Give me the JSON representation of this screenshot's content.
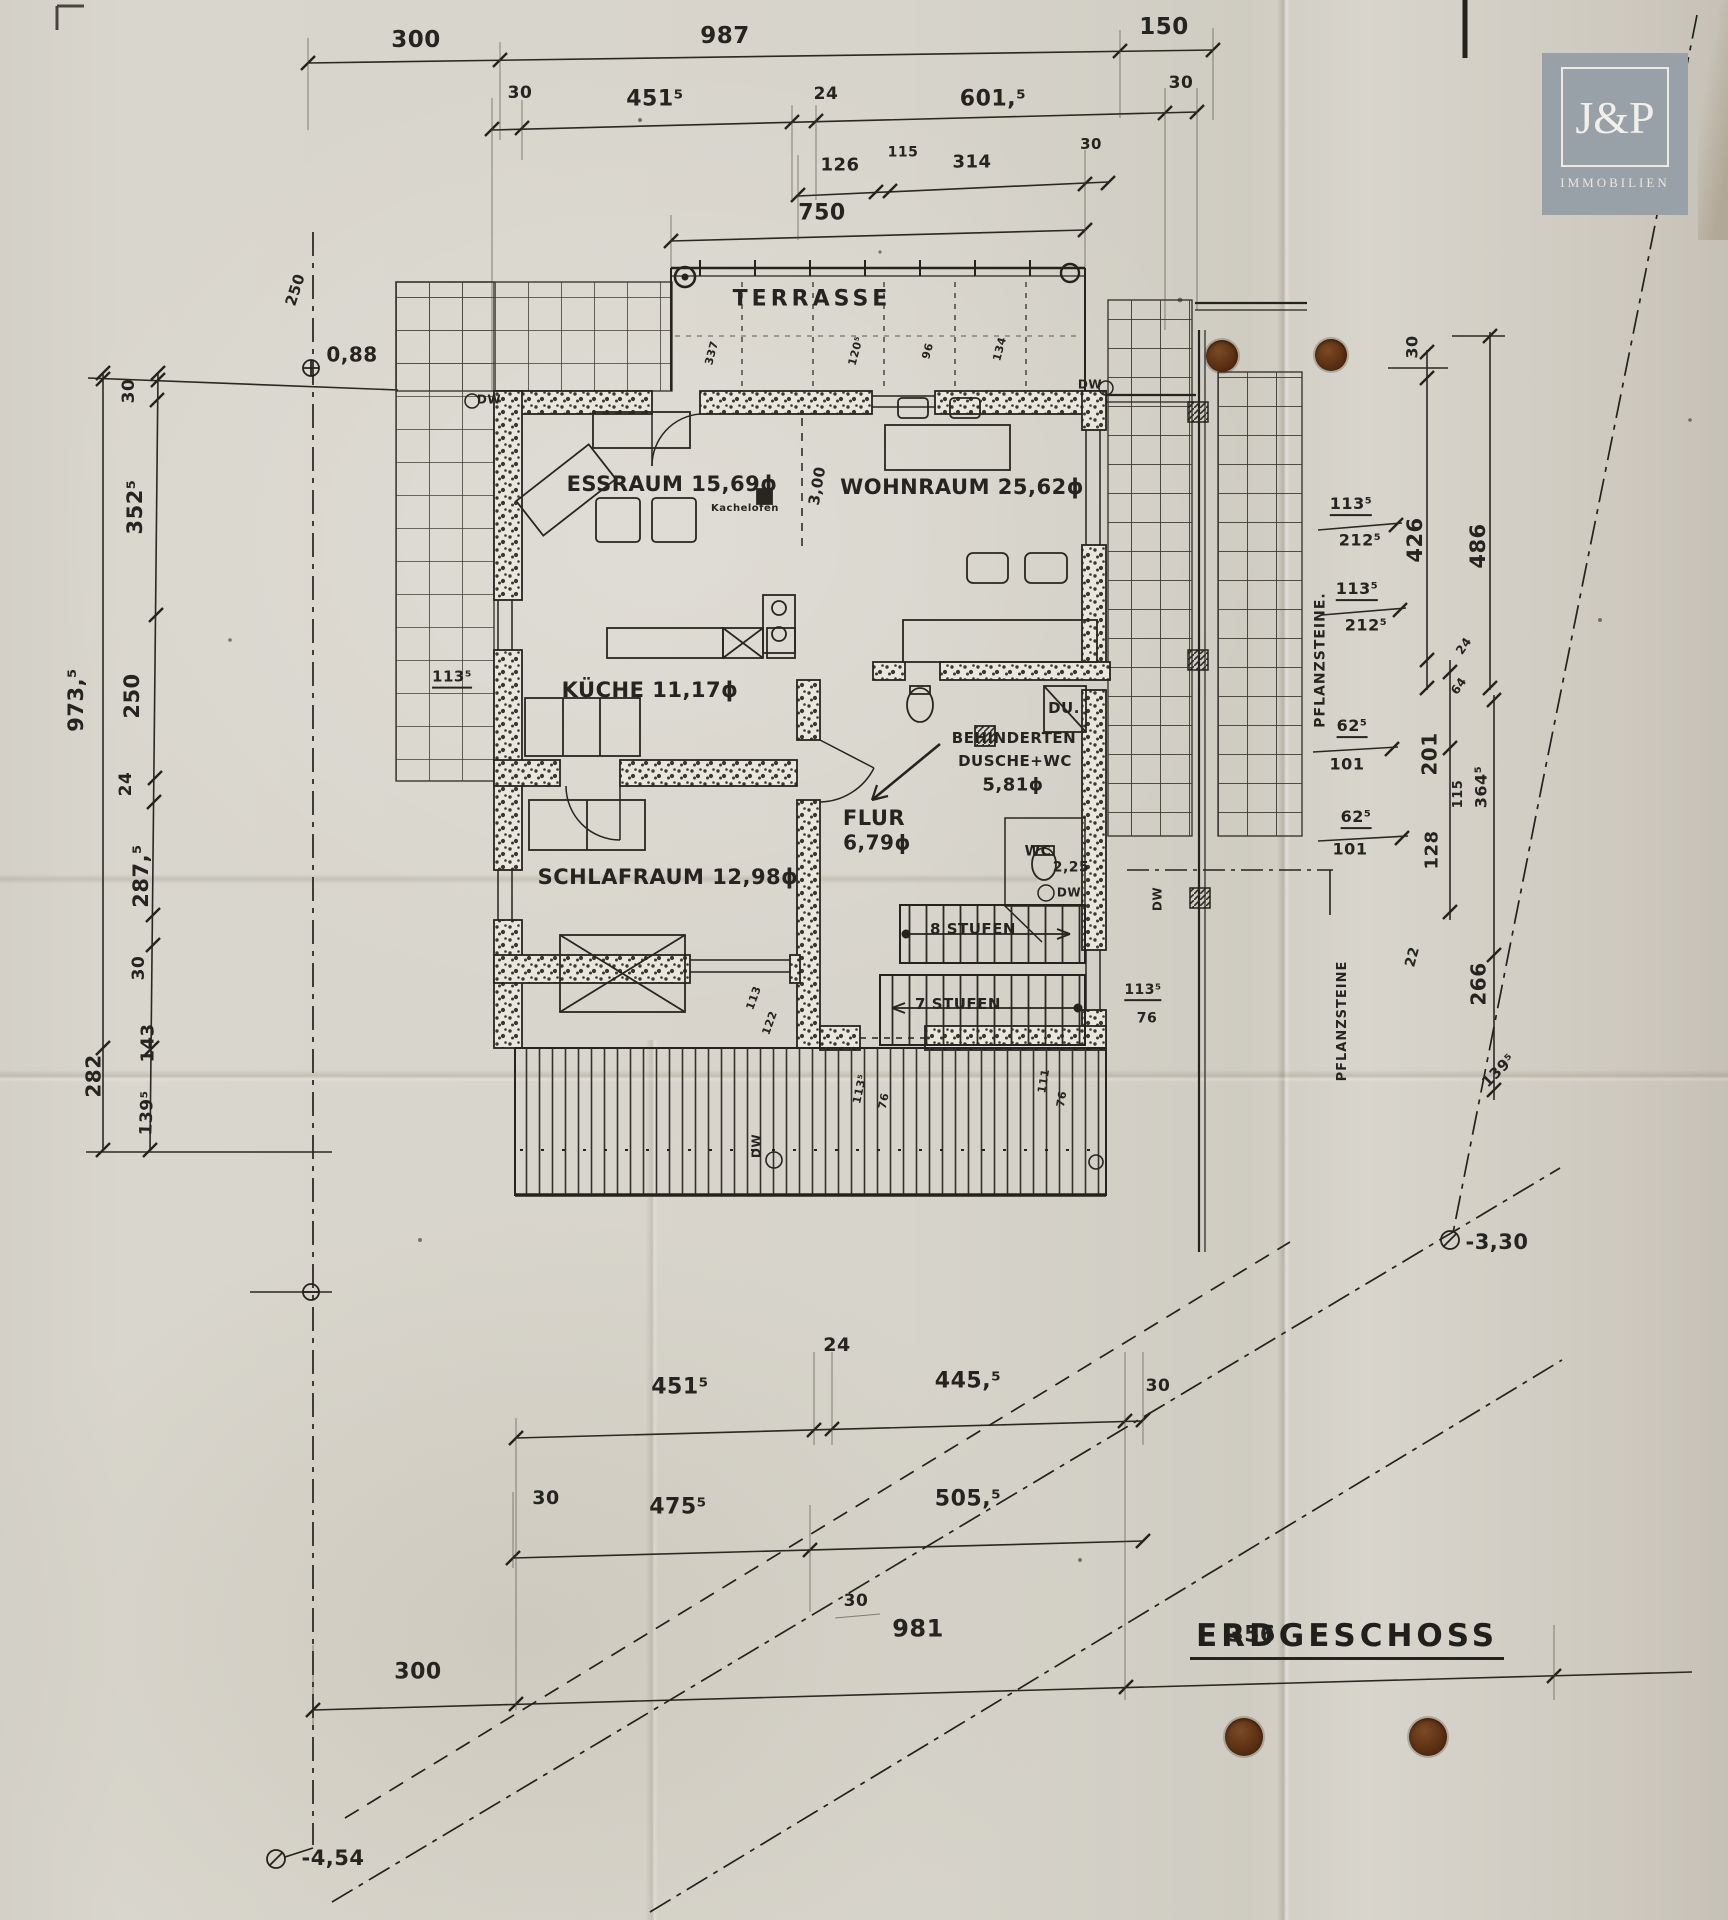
{
  "page": {
    "background": "#d5d2c9",
    "ink": "#23221e",
    "hole_color": "#53290f",
    "logo_bg": "#98a1a7"
  },
  "logo": {
    "name": "J&P",
    "subtitle": "IMMOBILIEN"
  },
  "plan": {
    "floor_label": "ERDGESCHOSS"
  },
  "rooms": [
    {
      "name": "TERRASSE",
      "area_qm": ""
    },
    {
      "name": "ESSRAUM",
      "area_qm": "15,69"
    },
    {
      "name": "WOHNRAUM",
      "area_qm": "25,62"
    },
    {
      "name": "KÜCHE",
      "area_qm": "11,17"
    },
    {
      "name": "SCHLAFRAUM",
      "area_qm": "12,98"
    },
    {
      "name": "FLUR",
      "area_qm": "6,79"
    },
    {
      "name": "BEHINDERTEN DUSCHE+WC",
      "area_qm": "5,81"
    },
    {
      "name": "WC",
      "area_qm": "2,25"
    }
  ],
  "elevations": [
    "0,88",
    "-3,30",
    "-4,54"
  ],
  "stairs": [
    "8 STUFEN",
    "7 STUFEN"
  ],
  "annotations": [
    {
      "t": "300",
      "x": 416,
      "y": 40,
      "s": 23
    },
    {
      "t": "987",
      "x": 725,
      "y": 36,
      "s": 23
    },
    {
      "t": "150",
      "x": 1164,
      "y": 27,
      "s": 23
    },
    {
      "t": "30",
      "x": 520,
      "y": 94,
      "s": 17
    },
    {
      "t": "451⁵",
      "x": 655,
      "y": 99,
      "s": 22
    },
    {
      "t": "24",
      "x": 826,
      "y": 95,
      "s": 17
    },
    {
      "t": "601,⁵",
      "x": 993,
      "y": 99,
      "s": 22
    },
    {
      "t": "30",
      "x": 1181,
      "y": 84,
      "s": 17
    },
    {
      "t": "126",
      "x": 840,
      "y": 166,
      "s": 18
    },
    {
      "t": "115",
      "x": 903,
      "y": 153,
      "s": 14
    },
    {
      "t": "314",
      "x": 972,
      "y": 163,
      "s": 18
    },
    {
      "t": "30",
      "x": 1091,
      "y": 145,
      "s": 15
    },
    {
      "t": "750",
      "x": 822,
      "y": 213,
      "s": 22
    },
    {
      "t": "30",
      "x": 130,
      "y": 391,
      "r": -90,
      "s": 17
    },
    {
      "t": "352⁵",
      "x": 135,
      "y": 507,
      "r": -90,
      "s": 21
    },
    {
      "t": "250",
      "x": 132,
      "y": 696,
      "r": -90,
      "s": 21
    },
    {
      "t": "973,⁵",
      "x": 76,
      "y": 700,
      "r": -90,
      "s": 21
    },
    {
      "t": "24",
      "x": 127,
      "y": 784,
      "r": -90,
      "s": 17
    },
    {
      "t": "287,⁵",
      "x": 141,
      "y": 876,
      "r": -90,
      "s": 21
    },
    {
      "t": "30",
      "x": 140,
      "y": 968,
      "r": -90,
      "s": 17
    },
    {
      "t": "143",
      "x": 149,
      "y": 1043,
      "r": -90,
      "s": 18
    },
    {
      "t": "282",
      "x": 94,
      "y": 1076,
      "r": -90,
      "s": 20
    },
    {
      "t": "139⁵",
      "x": 148,
      "y": 1113,
      "r": -88,
      "s": 17
    },
    {
      "t": "250",
      "x": 296,
      "y": 290,
      "r": -72,
      "s": 15
    },
    {
      "t": "0,88",
      "x": 352,
      "y": 355,
      "s": 20
    },
    {
      "t": "-3,30",
      "x": 1497,
      "y": 1242,
      "s": 21
    },
    {
      "t": "-4,54",
      "x": 333,
      "y": 1858,
      "s": 21
    },
    {
      "t": "TERRASSE",
      "x": 812,
      "y": 299,
      "s": 22,
      "ls": 4,
      "n": "room-label"
    },
    {
      "t": "ESSRAUM 15,69ϕ",
      "x": 672,
      "y": 484,
      "s": 21,
      "n": "room-label"
    },
    {
      "t": "WOHNRAUM 25,62ϕ",
      "x": 962,
      "y": 487,
      "s": 21,
      "n": "room-label"
    },
    {
      "t": "Kachelofen",
      "x": 745,
      "y": 509,
      "s": 10,
      "n": "note-label"
    },
    {
      "t": "3,00",
      "x": 818,
      "y": 486,
      "r": -80,
      "s": 15
    },
    {
      "t": "KÜCHE 11,17ϕ",
      "x": 650,
      "y": 690,
      "s": 21,
      "n": "room-label"
    },
    {
      "t": "SCHLAFRAUM 12,98ϕ",
      "x": 668,
      "y": 877,
      "s": 21,
      "n": "room-label"
    },
    {
      "t": "FLUR",
      "x": 874,
      "y": 818,
      "s": 21,
      "n": "room-label"
    },
    {
      "t": "6,79ϕ",
      "x": 877,
      "y": 843,
      "s": 20,
      "n": "room-label"
    },
    {
      "t": "BEHINDERTEN",
      "x": 1014,
      "y": 739,
      "s": 15,
      "n": "room-label"
    },
    {
      "t": "DUSCHE+WC",
      "x": 1015,
      "y": 762,
      "s": 15,
      "n": "room-label"
    },
    {
      "t": "5,81ϕ",
      "x": 1013,
      "y": 786,
      "s": 18,
      "n": "room-label"
    },
    {
      "t": "DU.",
      "x": 1064,
      "y": 709,
      "s": 15
    },
    {
      "t": "WC",
      "x": 1038,
      "y": 852,
      "s": 14,
      "n": "room-label"
    },
    {
      "t": "2,25",
      "x": 1071,
      "y": 868,
      "s": 14
    },
    {
      "t": "8 STUFEN",
      "x": 973,
      "y": 930,
      "s": 15
    },
    {
      "t": "7 STUFEN",
      "x": 958,
      "y": 1005,
      "s": 15
    },
    {
      "t": "DW",
      "x": 489,
      "y": 400,
      "s": 12
    },
    {
      "t": "DW",
      "x": 1090,
      "y": 385,
      "s": 12
    },
    {
      "t": "DW",
      "x": 1069,
      "y": 893,
      "s": 12
    },
    {
      "t": "DW",
      "x": 757,
      "y": 1146,
      "r": -90,
      "s": 12
    },
    {
      "t": "DW",
      "x": 1158,
      "y": 899,
      "r": -90,
      "s": 12
    },
    {
      "t": "337",
      "x": 712,
      "y": 353,
      "r": -75,
      "s": 11
    },
    {
      "t": "120⁵",
      "x": 856,
      "y": 351,
      "r": -75,
      "s": 11
    },
    {
      "t": "96",
      "x": 928,
      "y": 351,
      "r": -75,
      "s": 11
    },
    {
      "t": "134",
      "x": 1000,
      "y": 349,
      "r": -75,
      "s": 11
    },
    {
      "t": "113⁵",
      "x": 452,
      "y": 679,
      "s": 15,
      "u": 1
    },
    {
      "t": "113",
      "x": 754,
      "y": 998,
      "r": -70,
      "s": 11
    },
    {
      "t": "122",
      "x": 770,
      "y": 1023,
      "r": -70,
      "s": 11
    },
    {
      "t": "113⁵",
      "x": 860,
      "y": 1089,
      "r": -78,
      "s": 11
    },
    {
      "t": "76",
      "x": 884,
      "y": 1101,
      "r": -78,
      "s": 11
    },
    {
      "t": "111",
      "x": 1044,
      "y": 1081,
      "r": -80,
      "s": 11
    },
    {
      "t": "76",
      "x": 1062,
      "y": 1099,
      "r": -80,
      "s": 11
    },
    {
      "t": "113⁵",
      "x": 1143,
      "y": 992,
      "s": 14,
      "u": 1
    },
    {
      "t": "76",
      "x": 1147,
      "y": 1019,
      "s": 14
    },
    {
      "t": "30",
      "x": 1413,
      "y": 347,
      "r": -90,
      "s": 16
    },
    {
      "t": "426",
      "x": 1415,
      "y": 540,
      "r": -90,
      "s": 21
    },
    {
      "t": "486",
      "x": 1478,
      "y": 546,
      "r": -90,
      "s": 21
    },
    {
      "t": "113⁵",
      "x": 1351,
      "y": 506,
      "s": 16,
      "u": 1
    },
    {
      "t": "212⁵",
      "x": 1360,
      "y": 541,
      "s": 16
    },
    {
      "t": "113⁵",
      "x": 1357,
      "y": 591,
      "s": 16,
      "u": 1
    },
    {
      "t": "212⁵",
      "x": 1366,
      "y": 626,
      "s": 16
    },
    {
      "t": "24",
      "x": 1464,
      "y": 646,
      "r": -55,
      "s": 12
    },
    {
      "t": "64",
      "x": 1459,
      "y": 686,
      "r": -55,
      "s": 12
    },
    {
      "t": "PFLANZSTEINE.",
      "x": 1321,
      "y": 660,
      "r": -90,
      "s": 14,
      "ls": 1
    },
    {
      "t": "62⁵",
      "x": 1352,
      "y": 728,
      "s": 16,
      "u": 1
    },
    {
      "t": "101",
      "x": 1347,
      "y": 765,
      "s": 16
    },
    {
      "t": "201",
      "x": 1430,
      "y": 754,
      "r": -90,
      "s": 20
    },
    {
      "t": "62⁵",
      "x": 1356,
      "y": 819,
      "s": 16,
      "u": 1
    },
    {
      "t": "101",
      "x": 1350,
      "y": 850,
      "s": 16
    },
    {
      "t": "128",
      "x": 1433,
      "y": 850,
      "r": -90,
      "s": 18
    },
    {
      "t": "115",
      "x": 1459,
      "y": 794,
      "r": -90,
      "s": 13
    },
    {
      "t": "364⁵",
      "x": 1482,
      "y": 787,
      "r": -90,
      "s": 16
    },
    {
      "t": "22",
      "x": 1413,
      "y": 957,
      "r": -75,
      "s": 14
    },
    {
      "t": "266",
      "x": 1479,
      "y": 984,
      "r": -90,
      "s": 20
    },
    {
      "t": "PFLANZSTEINE",
      "x": 1343,
      "y": 1021,
      "r": -90,
      "s": 13,
      "ls": 1
    },
    {
      "t": "139⁵",
      "x": 1499,
      "y": 1071,
      "r": -45,
      "s": 15
    },
    {
      "t": "24",
      "x": 837,
      "y": 1346,
      "s": 19
    },
    {
      "t": "451⁵",
      "x": 680,
      "y": 1387,
      "s": 22
    },
    {
      "t": "445,⁵",
      "x": 968,
      "y": 1381,
      "s": 22
    },
    {
      "t": "30",
      "x": 1158,
      "y": 1387,
      "s": 17
    },
    {
      "t": "30",
      "x": 546,
      "y": 1499,
      "s": 19
    },
    {
      "t": "475⁵",
      "x": 678,
      "y": 1507,
      "s": 22
    },
    {
      "t": "505,⁵",
      "x": 968,
      "y": 1499,
      "s": 22
    },
    {
      "t": "30",
      "x": 856,
      "y": 1602,
      "s": 17
    },
    {
      "t": "981",
      "x": 918,
      "y": 1629,
      "s": 24
    },
    {
      "t": "356",
      "x": 1252,
      "y": 1635,
      "s": 22
    },
    {
      "t": "300",
      "x": 418,
      "y": 1672,
      "s": 22
    }
  ]
}
